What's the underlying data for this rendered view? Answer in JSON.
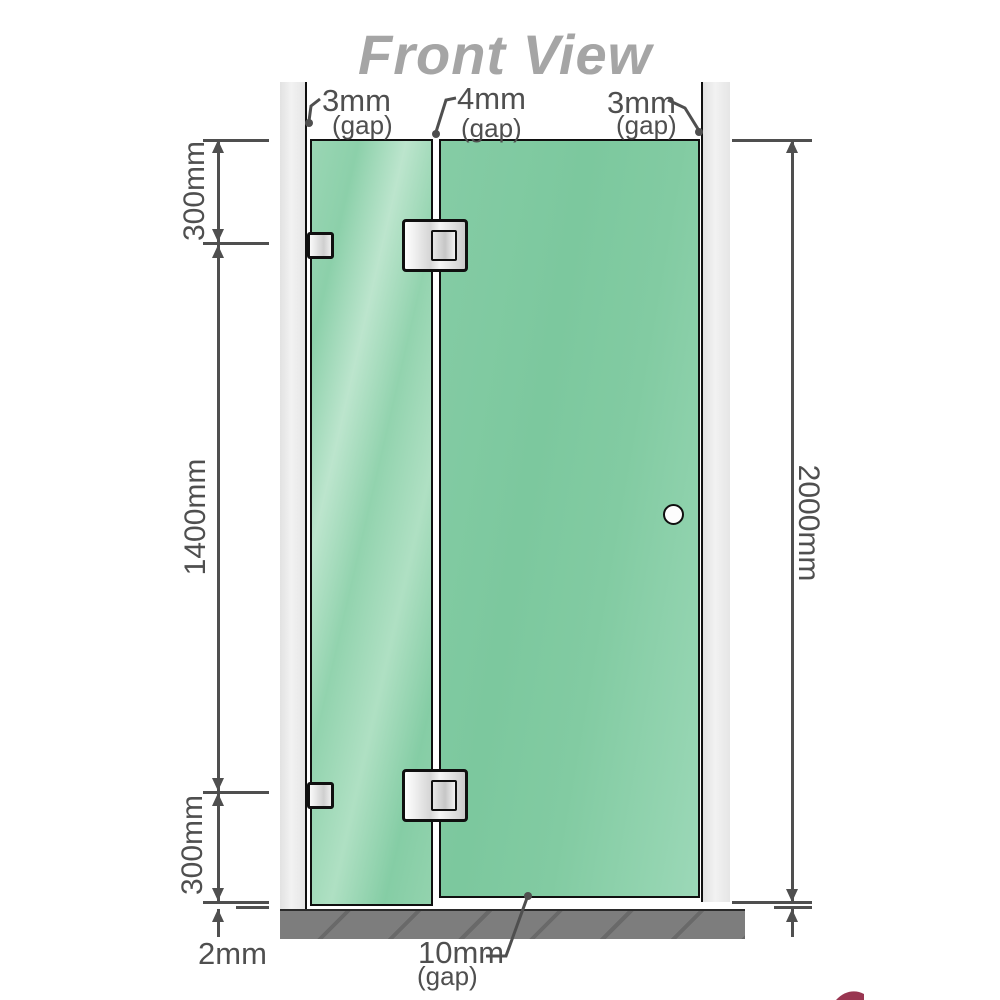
{
  "title": "Front View",
  "gap_labels": {
    "top_left": {
      "value": "3mm",
      "unit": "(gap)"
    },
    "top_middle": {
      "value": "4mm",
      "unit": "(gap)"
    },
    "top_right": {
      "value": "3mm",
      "unit": "(gap)"
    },
    "bottom": {
      "value": "10mm",
      "unit": "(gap)"
    }
  },
  "dimension_labels": {
    "left_top_segment": "300mm",
    "left_middle_segment": "1400mm",
    "left_bottom_segment": "300mm",
    "left_floor_gap": "2mm",
    "right_total_height": "2000mm"
  },
  "colors": {
    "glass_green": "#84cca4",
    "glass_highlight": "#bce5cd",
    "wall_gray": "#e9e9e9",
    "floor_gray": "#7d7d7d",
    "dimension_gray": "#4f4f4f",
    "title_gray": "#a5a5a5",
    "accent_red": "#8e203e"
  }
}
